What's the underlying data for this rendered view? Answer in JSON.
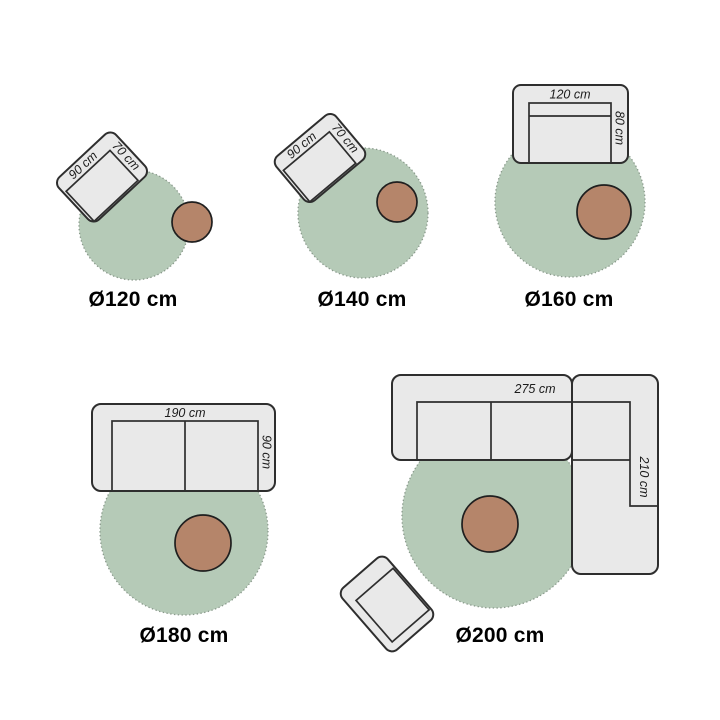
{
  "colors": {
    "background": "#ffffff",
    "rug_fill": "#b5cab7",
    "rug_border": "#8a9a8c",
    "furniture_fill": "#e9e9e9",
    "furniture_border": "#2e2e2e",
    "table_fill": "#b5856a",
    "table_border": "#1f1f1f",
    "label_text": "#000000",
    "dim_text": "#1c1c1c"
  },
  "panels": [
    {
      "label": "Ø120 cm",
      "rug_diameter_cm": 120,
      "furniture": {
        "type": "armchair",
        "width": "90 cm",
        "depth": "70 cm"
      },
      "extras": [
        "side-table"
      ]
    },
    {
      "label": "Ø140 cm",
      "rug_diameter_cm": 140,
      "furniture": {
        "type": "armchair",
        "width": "90 cm",
        "depth": "70 cm"
      },
      "extras": [
        "side-table"
      ]
    },
    {
      "label": "Ø160 cm",
      "rug_diameter_cm": 160,
      "furniture": {
        "type": "loveseat-sofa",
        "width": "120 cm",
        "depth": "80 cm"
      },
      "extras": [
        "side-table"
      ]
    },
    {
      "label": "Ø180 cm",
      "rug_diameter_cm": 180,
      "furniture": {
        "type": "two-seat-sofa",
        "width": "190 cm",
        "depth": "90 cm"
      },
      "extras": [
        "side-table"
      ]
    },
    {
      "label": "Ø200 cm",
      "rug_diameter_cm": 200,
      "furniture": {
        "type": "corner-sofa",
        "width": "275 cm",
        "depth": "210 cm"
      },
      "extras": [
        "side-table",
        "ottoman"
      ]
    }
  ]
}
